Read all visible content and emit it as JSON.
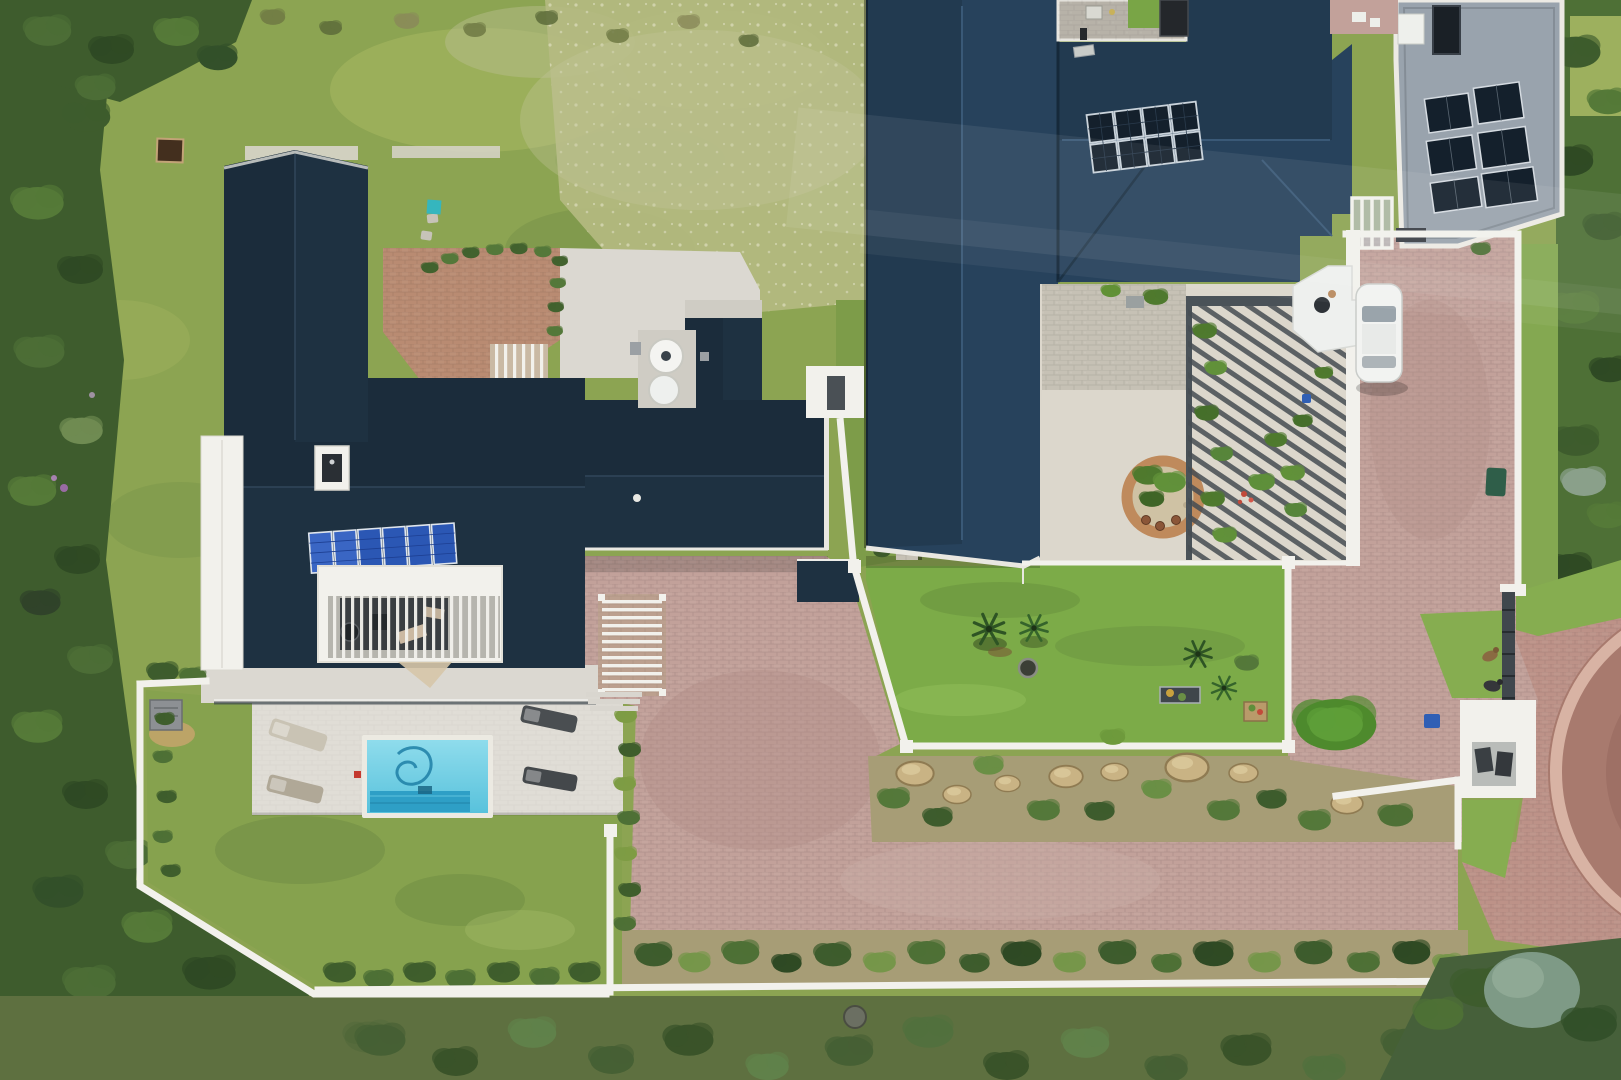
{
  "scene": {
    "type": "aerial-drone-photo",
    "description": "Top-down aerial drone photograph of two neighbouring luxury coastal homes with dark navy corrugated hip roofs and rooftop solar panels. The left house has an internal courtyard deck with pergola, a white-paved terrace with four sun loungers and a turquoise swimming pool with a cleaning hose, enclosed by white boundary walls and lawn. The right, larger house has a gravel inner courtyard with a circular brick planter, a slatted pergola with potted plants, a pink brick paved driveway with a parked white car, a bright lawn with palms and a fire pit, rock garden beds, two dogs by a gate and a brick turning circle. Wild green coastal vegetation borders the left, bottom and right edges."
  },
  "palette": {
    "lawn_base": "#8CA452",
    "lawn_bright": "#7CAB48",
    "lawn_south": "#86A24E",
    "meadow_pale": "#B5BA82",
    "veg_dark": "#3E5C2D",
    "veg_mid": "#4E7036",
    "veg_olive": "#5E7040",
    "roof_left": "#1E3141",
    "roof_right": "#27425C",
    "flat_roof": "#99A3AD",
    "white_wall": "#F2F1EC",
    "concrete": "#DBD8D1",
    "gravel": "#DCD7CC",
    "cobble": "#C6C1B5",
    "brick_drive": "#C2A19A",
    "brick_court": "#B98B72",
    "brick_circle": "#A87A6E",
    "pool_light": "#8FDCEC",
    "pool_mid": "#58C2DC",
    "pool_dark": "#2E9FC6",
    "solar_panel": "#14202C",
    "solar_blue": "#2B57B4",
    "garden_sand": "#A79D76",
    "rock": "#C9B384",
    "car_white": "#F2F3F1",
    "teal_marker": "#35B6BE",
    "bin_blue": "#2F5FB5",
    "bin_green": "#2F5E49",
    "dog_brown": "#8A6A42",
    "dog_dark": "#35363A"
  },
  "counts": {
    "left_house_solar_panels": 6,
    "right_house_ridge_solar_panels": 8,
    "flat_roof_solar_panels": 6,
    "sun_loungers": 4,
    "dogs": 2,
    "parked_cars": 1,
    "water_tanks": 2,
    "swimming_pools": 1
  },
  "features": {
    "left_house": "L-shaped single storey home, dark navy roof, 6 blue solar panels, white internal courtyard with deck and pergola",
    "right_house": "Large multi-wing home, navy hip roof with 8-panel solar array plus 6 tilted arrays on a grey flat roof",
    "swimming_pool": "Rectangular turquoise pool with tanning ledge and dark cleaner hose",
    "central_driveway": "Pink clay-brick paved driveway shared between the properties",
    "turning_circle": "Circular red-brick turning court at lower right",
    "courtyard_circle": "Circular brick-ringed planter in gravel courtyard",
    "stone_wall": "Old grey cobble wall running between the two properties",
    "boundary_walls": "Low white plastered boundary walls",
    "vegetation": "Dense wild coastal fynbos vegetation on the borders"
  }
}
